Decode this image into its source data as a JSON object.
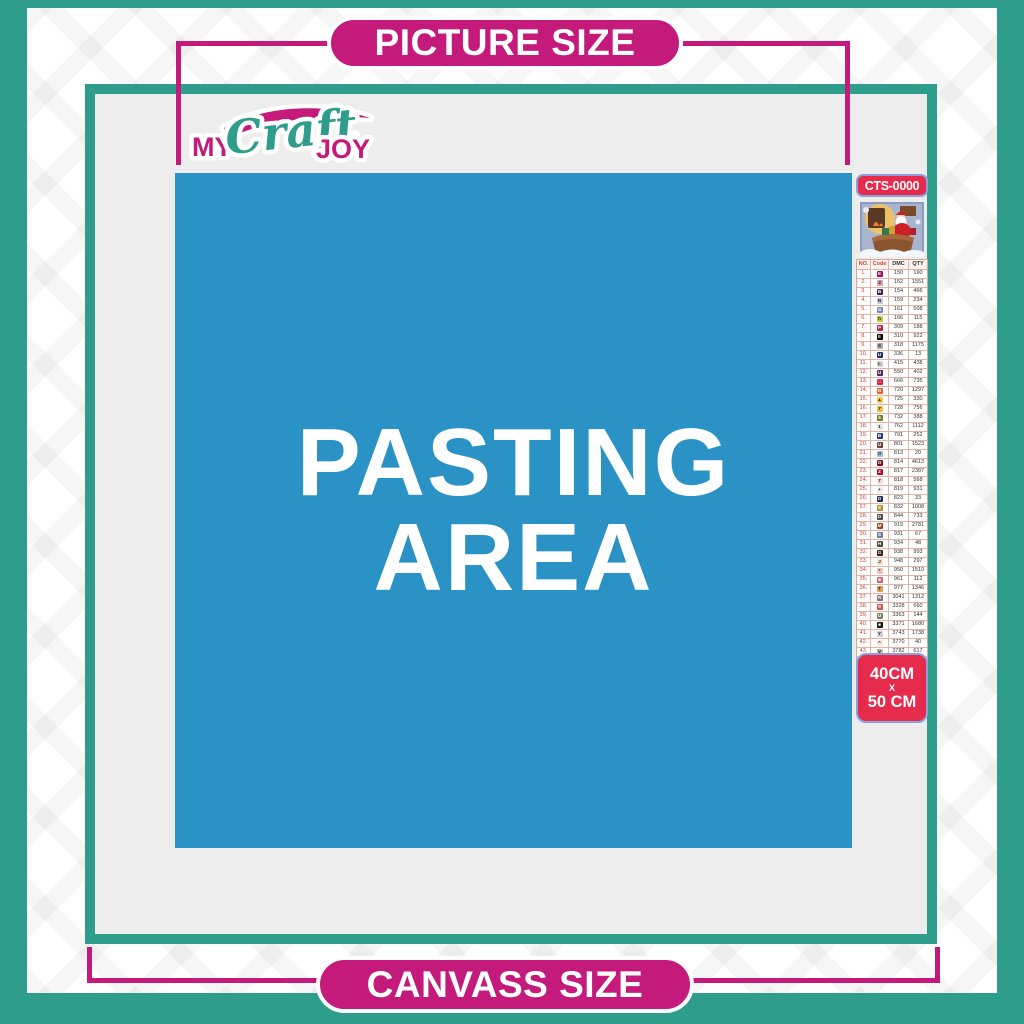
{
  "colors": {
    "teal": "#2f9d8c",
    "magenta": "#c31a7b",
    "blue": "#2b92c5",
    "red_badge": "#e62b4c",
    "badge_border": "#8ca0de",
    "canvas_fill": "#ededed"
  },
  "banners": {
    "picture_size": "PICTURE SIZE",
    "canvass_size": "CANVASS SIZE"
  },
  "logo": {
    "my": "MY",
    "craft": "Craft",
    "joy": "JOY"
  },
  "pasting_area": {
    "line1": "PASTING",
    "line2": "AREA"
  },
  "sidebar": {
    "design_code": "CTS-0000",
    "thumbnail": "christmas-santa-sleigh-artwork",
    "size_badge": {
      "width": "40CM",
      "sep": "X",
      "height": "50 CM"
    },
    "table": {
      "headers": [
        "NO.",
        "Code",
        "DMC",
        "QTY"
      ],
      "rows": [
        {
          "no": "1.",
          "sym": "E",
          "bg": "#a3134b",
          "fg": "#fff",
          "dmc": "150",
          "qty": "190"
        },
        {
          "no": "2.",
          "sym": "3",
          "bg": "#dfa0a6",
          "fg": "#222",
          "dmc": "152",
          "qty": "1551"
        },
        {
          "no": "3.",
          "sym": "B",
          "bg": "#4b2640",
          "fg": "#fff",
          "dmc": "154",
          "qty": "466"
        },
        {
          "no": "4.",
          "sym": "N",
          "bg": "#c3c8dc",
          "fg": "#222",
          "dmc": "159",
          "qty": "234"
        },
        {
          "no": "5.",
          "sym": "G",
          "bg": "#7d87b1",
          "fg": "#fff",
          "dmc": "161",
          "qty": "508"
        },
        {
          "no": "6.",
          "sym": "h",
          "bg": "#c0cc44",
          "fg": "#222",
          "dmc": "166",
          "qty": "115"
        },
        {
          "no": "7.",
          "sym": "P",
          "bg": "#b8294e",
          "fg": "#fff",
          "dmc": "309",
          "qty": "188"
        },
        {
          "no": "8.",
          "sym": "E",
          "bg": "#000000",
          "fg": "#fff",
          "dmc": "310",
          "qty": "922"
        },
        {
          "no": "9.",
          "sym": "X",
          "bg": "#a9a9ad",
          "fg": "#222",
          "dmc": "318",
          "qty": "1175"
        },
        {
          "no": "10.",
          "sym": "U",
          "bg": "#20345f",
          "fg": "#fff",
          "dmc": "336",
          "qty": "13"
        },
        {
          "no": "11.",
          "sym": "L",
          "bg": "#d0d0d4",
          "fg": "#222",
          "dmc": "415",
          "qty": "438"
        },
        {
          "no": "12.",
          "sym": "U",
          "bg": "#542a62",
          "fg": "#fff",
          "dmc": "550",
          "qty": "402"
        },
        {
          "no": "13.",
          "sym": "□",
          "bg": "#e01f3c",
          "fg": "#fff",
          "dmc": "666",
          "qty": "735"
        },
        {
          "no": "14.",
          "sym": "N",
          "bg": "#e66425",
          "fg": "#fff",
          "dmc": "720",
          "qty": "1297"
        },
        {
          "no": "15.",
          "sym": "▲",
          "bg": "#ffc640",
          "fg": "#222",
          "dmc": "725",
          "qty": "330"
        },
        {
          "no": "16.",
          "sym": "7",
          "bg": "#f4bb47",
          "fg": "#222",
          "dmc": "728",
          "qty": "756"
        },
        {
          "no": "17.",
          "sym": "5",
          "bg": "#7e7b26",
          "fg": "#fff",
          "dmc": "732",
          "qty": "388"
        },
        {
          "no": "18.",
          "sym": "1",
          "bg": "#e6e6e8",
          "fg": "#222",
          "dmc": "762",
          "qty": "1112"
        },
        {
          "no": "19.",
          "sym": "B",
          "bg": "#31397c",
          "fg": "#fff",
          "dmc": "791",
          "qty": "252"
        },
        {
          "no": "20.",
          "sym": "U",
          "bg": "#6a4330",
          "fg": "#fff",
          "dmc": "801",
          "qty": "1523"
        },
        {
          "no": "21.",
          "sym": "O",
          "bg": "#9fc0d8",
          "fg": "#222",
          "dmc": "813",
          "qty": "20"
        },
        {
          "no": "22.",
          "sym": "O",
          "bg": "#770f25",
          "fg": "#fff",
          "dmc": "814",
          "qty": "4613"
        },
        {
          "no": "23.",
          "sym": "Z",
          "bg": "#b00d24",
          "fg": "#fff",
          "dmc": "817",
          "qty": "2387"
        },
        {
          "no": "24.",
          "sym": "7",
          "bg": "#f9d8d8",
          "fg": "#222",
          "dmc": "818",
          "qty": "568"
        },
        {
          "no": "25.",
          "sym": "+",
          "bg": "#fbe9e7",
          "fg": "#222",
          "dmc": "819",
          "qty": "931"
        },
        {
          "no": "26.",
          "sym": "D",
          "bg": "#1d2c57",
          "fg": "#fff",
          "dmc": "823",
          "qty": "33"
        },
        {
          "no": "27.",
          "sym": "8",
          "bg": "#b98f34",
          "fg": "#fff",
          "dmc": "832",
          "qty": "1008"
        },
        {
          "no": "28.",
          "sym": "D",
          "bg": "#4e4d4b",
          "fg": "#fff",
          "dmc": "844",
          "qty": "733"
        },
        {
          "no": "29.",
          "sym": "M",
          "bg": "#a04022",
          "fg": "#fff",
          "dmc": "919",
          "qty": "2781"
        },
        {
          "no": "30.",
          "sym": "S",
          "bg": "#68829e",
          "fg": "#fff",
          "dmc": "931",
          "qty": "67"
        },
        {
          "no": "31.",
          "sym": "H",
          "bg": "#4c4e38",
          "fg": "#fff",
          "dmc": "934",
          "qty": "48"
        },
        {
          "no": "32.",
          "sym": "G",
          "bg": "#39230f",
          "fg": "#fff",
          "dmc": "938",
          "qty": "993"
        },
        {
          "no": "33.",
          "sym": "J",
          "bg": "#f6dcc8",
          "fg": "#222",
          "dmc": "948",
          "qty": "297"
        },
        {
          "no": "34.",
          "sym": "*",
          "bg": "#edc5ac",
          "fg": "#222",
          "dmc": "950",
          "qty": "1510"
        },
        {
          "no": "35.",
          "sym": "■",
          "bg": "#d0647e",
          "fg": "#fff",
          "dmc": "961",
          "qty": "112"
        },
        {
          "no": "36.",
          "sym": "T",
          "bg": "#da9c51",
          "fg": "#222",
          "dmc": "977",
          "qty": "1346"
        },
        {
          "no": "37.",
          "sym": "R",
          "bg": "#8e6b7e",
          "fg": "#fff",
          "dmc": "3041",
          "qty": "1312"
        },
        {
          "no": "38.",
          "sym": "9",
          "bg": "#c65b57",
          "fg": "#fff",
          "dmc": "3328",
          "qty": "660"
        },
        {
          "no": "39.",
          "sym": "U",
          "bg": "#76855c",
          "fg": "#fff",
          "dmc": "3363",
          "qty": "144"
        },
        {
          "no": "40.",
          "sym": "■",
          "bg": "#241107",
          "fg": "#fff",
          "dmc": "3371",
          "qty": "1680"
        },
        {
          "no": "41.",
          "sym": "Y",
          "bg": "#d5cada",
          "fg": "#222",
          "dmc": "3743",
          "qty": "1738"
        },
        {
          "no": "42.",
          "sym": "^",
          "bg": "#fbe6d7",
          "fg": "#222",
          "dmc": "3770",
          "qty": "40"
        },
        {
          "no": "43.",
          "sym": "V",
          "bg": "#cdb599",
          "fg": "#222",
          "dmc": "3782",
          "qty": "617"
        },
        {
          "no": "44.",
          "sym": "2",
          "bg": "#dce05e",
          "fg": "#222",
          "dmc": "3819",
          "qty": "119"
        },
        {
          "no": "45.",
          "sym": "/",
          "bg": "#fdf4cf",
          "fg": "#222",
          "dmc": "3823",
          "qty": "107"
        },
        {
          "no": "46.",
          "sym": "C",
          "bg": "#ef9546",
          "fg": "#222",
          "dmc": "3853",
          "qty": "1332"
        },
        {
          "no": "47.",
          "sym": "K",
          "bg": "#7d423a",
          "fg": "#fff",
          "dmc": "3858",
          "qty": "2311"
        },
        {
          "no": "48.",
          "sym": "A",
          "bg": "#a3835f",
          "fg": "#fff",
          "dmc": "3863",
          "qty": "1820"
        }
      ]
    }
  }
}
